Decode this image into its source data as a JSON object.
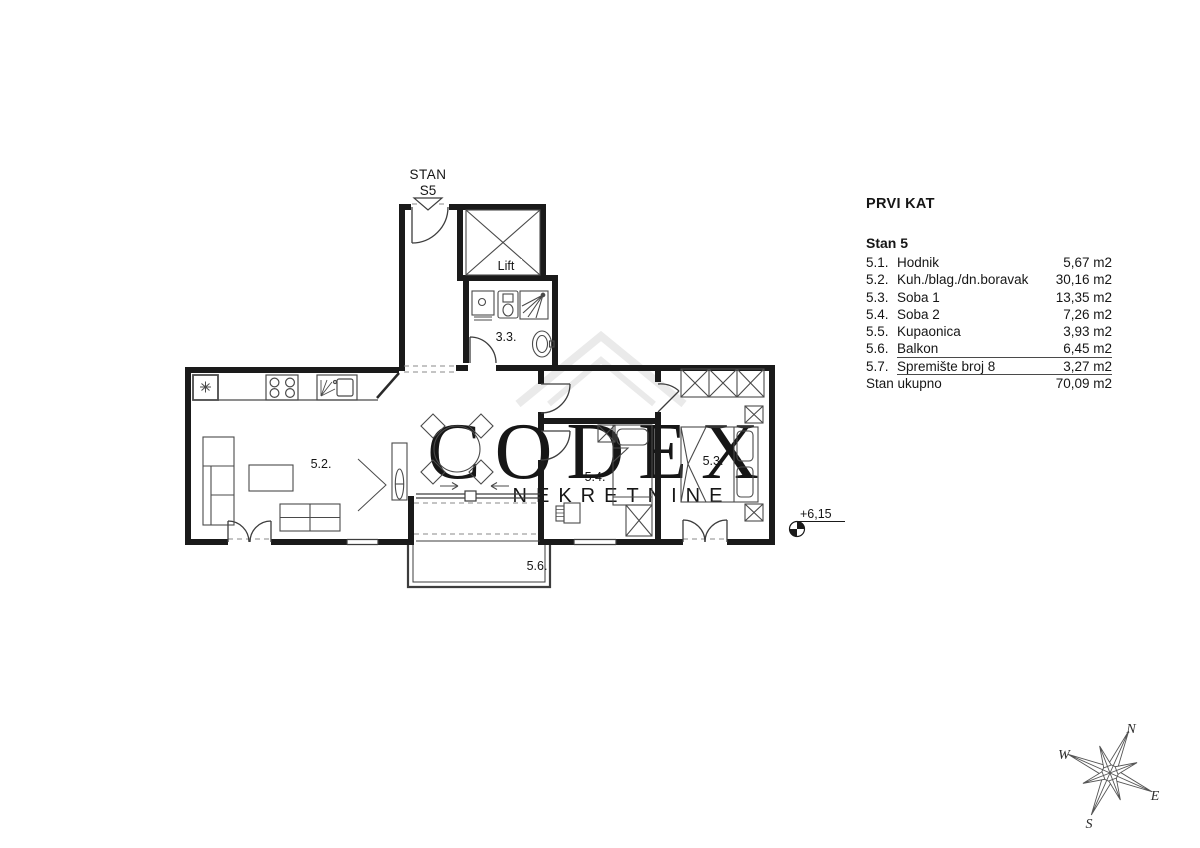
{
  "plan": {
    "entrance": {
      "line1": "STAN",
      "line2": "S5"
    },
    "labels": {
      "lift": "Lift",
      "bathroom": "3.3.",
      "living": "5.2.",
      "bedroom2": "5.4.",
      "bedroom1": "5.3.",
      "balcony": "5.6.",
      "elevation": "+6,15"
    }
  },
  "legend": {
    "floor_title": "PRVI KAT",
    "unit_title": "Stan 5",
    "rows": [
      {
        "no": "5.1.",
        "name": "Hodnik",
        "area": "5,67 m2"
      },
      {
        "no": "5.2.",
        "name": "Kuh./blag./dn.boravak",
        "area": "30,16 m2"
      },
      {
        "no": "5.3.",
        "name": "Soba 1",
        "area": "13,35 m2"
      },
      {
        "no": "5.4.",
        "name": "Soba 2",
        "area": "7,26 m2"
      },
      {
        "no": "5.5.",
        "name": "Kupaonica",
        "area": "3,93 m2"
      },
      {
        "no": "5.6.",
        "name": "Balkon",
        "area": "6,45 m2"
      },
      {
        "no": "5.7.",
        "name": "Spremište broj 8",
        "area": "3,27 m2"
      }
    ],
    "total": {
      "name": "Stan ukupno",
      "area": "70,09 m2"
    }
  },
  "watermark": {
    "line1": "CODEX",
    "line2": "NEKRETNINE"
  },
  "compass": {
    "north": "N",
    "east": "E",
    "south": "S",
    "west": "W"
  }
}
